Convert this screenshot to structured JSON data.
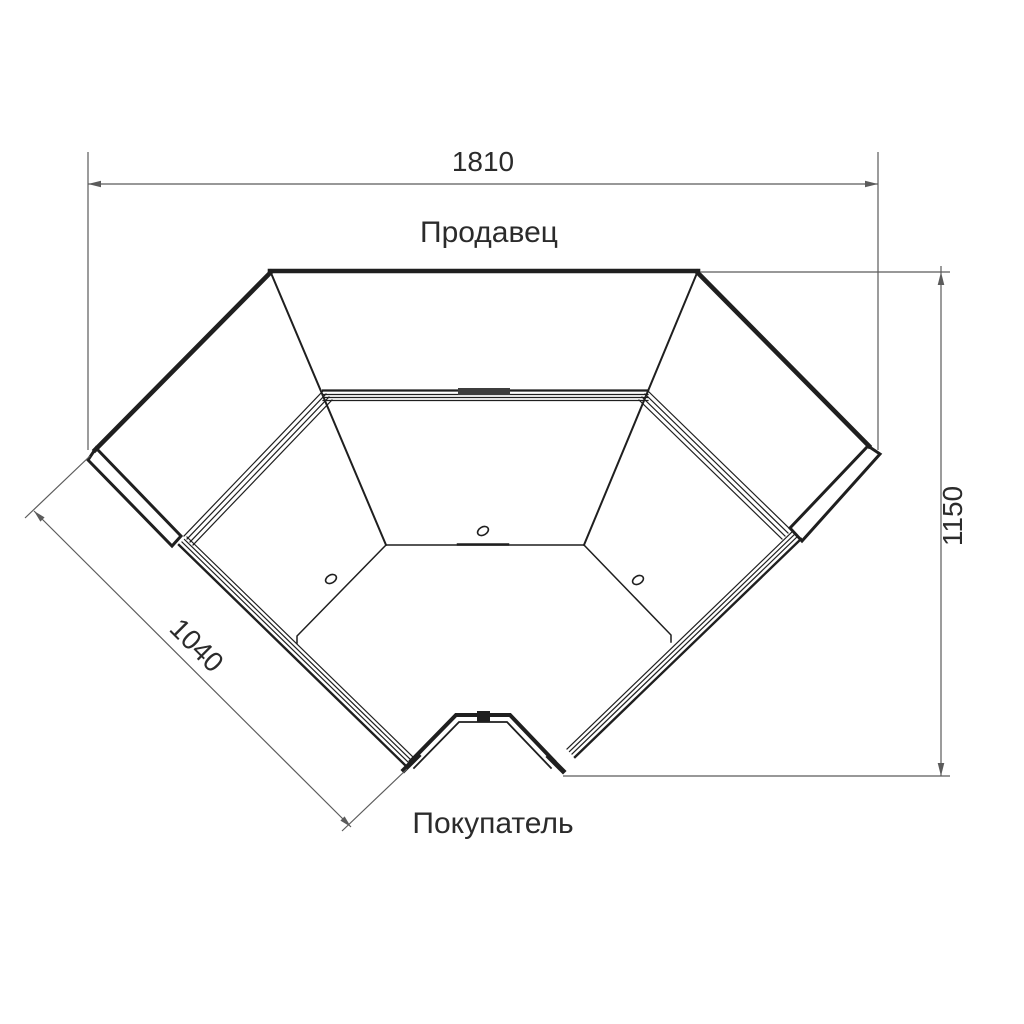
{
  "drawing": {
    "labels": {
      "seller": "Продавец",
      "buyer": "Покупатель"
    },
    "dimensions": {
      "top_width": "1810",
      "right_height": "1150",
      "left_depth": "1040"
    },
    "colors": {
      "background": "#ffffff",
      "line": "#1f1f1f",
      "band": "#3d3d3d",
      "dimension": "#5b5b5b",
      "text": "#2b2b2b"
    }
  }
}
